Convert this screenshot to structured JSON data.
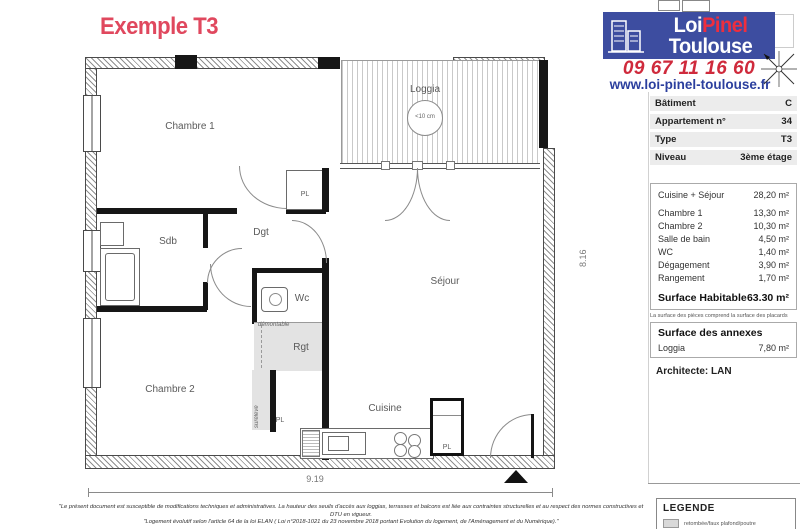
{
  "title": "Exemple T3",
  "brand": {
    "name_part1": "Loi",
    "name_part2": "Pinel",
    "name_part3": "Toulouse",
    "phone": "09 67 11 16 60",
    "website": "www.loi-pinel-toulouse.fr"
  },
  "info": {
    "rows": [
      {
        "label": "Bâtiment",
        "value": "C"
      },
      {
        "label": "Appartement n°",
        "value": "34"
      },
      {
        "label": "Type",
        "value": "T3"
      },
      {
        "label": "Niveau",
        "value": "3ème étage"
      }
    ]
  },
  "surfaces": {
    "rooms": [
      {
        "name": "Cuisine + Séjour",
        "area": "28,20 m²"
      },
      {
        "name": "Chambre 1",
        "area": "13,30 m²"
      },
      {
        "name": "Chambre 2",
        "area": "10,30 m²"
      },
      {
        "name": "Salle de bain",
        "area": "4,50 m²"
      },
      {
        "name": "WC",
        "area": "1,40 m²"
      },
      {
        "name": "Dégagement",
        "area": "3,90 m²"
      },
      {
        "name": "Rangement",
        "area": "1,70 m²"
      }
    ],
    "total_label": "Surface Habitable",
    "total_value": "63.30 m²",
    "note": "La surface des pièces comprend la surface des placards"
  },
  "annexes": {
    "title": "Surface des annexes",
    "rows": [
      {
        "name": "Loggia",
        "area": "7,80 m²"
      }
    ]
  },
  "architect": "Architecte: LAN",
  "legend": {
    "title": "LEGENDE",
    "items": [
      {
        "label": "retombée/faux plafond/poutre",
        "swatch_color": "#d9d9d9"
      }
    ]
  },
  "plan": {
    "labels": {
      "chambre1": "Chambre 1",
      "chambre2": "Chambre 2",
      "sejour": "Séjour",
      "cuisine": "Cuisine",
      "loggia": "Loggia",
      "loggia_note": "<10 cm",
      "sdb": "Sdb",
      "dgt": "Dgt",
      "wc": "Wc",
      "rgt": "Rgt",
      "pl": "PL",
      "demontable": "démontable",
      "sureleve": "surélevé"
    },
    "dimensions": {
      "width": "9.19",
      "height": "8.16"
    }
  },
  "disclaimer": {
    "line1": "\"Le présent document est susceptible de modifications techniques et administratives. La hauteur des seuils d'accès aux loggias, terrasses et balcons est liée aux contraintes structurelles et au respect des normes constructives et DTU en vigueur.",
    "line2": "\"Logement évolutif selon l'article 64 de la loi ELAN ( Loi n°2018-1021 du 23 novembre 2018 portant Evolution du logement, de l'Aménagement et du Numérique).\""
  },
  "colors": {
    "brand_blue": "#3d4da0",
    "brand_red": "#ee2e3e",
    "phone_red": "#cf2a3c",
    "link_blue": "#2b3f9e",
    "title_pink": "#e0485e",
    "legend_gray": "#d9d9d9"
  }
}
